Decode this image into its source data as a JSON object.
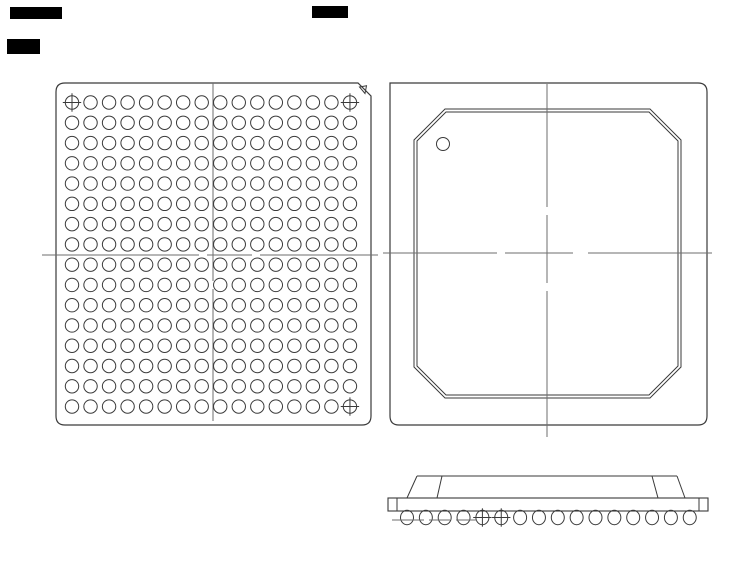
{
  "document": {
    "kind": "bga-package-mechanical-drawing",
    "background": "#ffffff",
    "line_color": "#3a3a3a",
    "centerline_color": "#6e6e6e",
    "width": 754,
    "height": 576
  },
  "redactions": [
    {
      "x": 10,
      "y": 7,
      "w": 52,
      "h": 12
    },
    {
      "x": 7,
      "y": 39,
      "w": 33,
      "h": 15
    },
    {
      "x": 312,
      "y": 6,
      "w": 36,
      "h": 12
    }
  ],
  "bottom_view": {
    "name": "package-bottom-view-ball-grid",
    "outline": {
      "x": 56,
      "y": 83,
      "w": 315,
      "h": 342,
      "notch_r": 9,
      "pin1_chamfer": 13
    },
    "pin1_triangle": {
      "points": "359.5,87 366.5,85.8 365,93.5"
    },
    "ball_grid": {
      "cols": 16,
      "rows": 16,
      "x0": 72,
      "y0": 102.5,
      "dx": 18.53,
      "dy": 20.27,
      "ball_r": 6.7,
      "crosshair_cells": [
        {
          "col": 0,
          "row": 0
        },
        {
          "col": 15,
          "row": 0
        },
        {
          "col": 15,
          "row": 15
        }
      ]
    },
    "centerline_h": {
      "y": 255,
      "segments": [
        [
          42,
          199
        ],
        [
          207,
          252
        ],
        [
          260,
          378
        ]
      ]
    },
    "centerline_v": {
      "x": 213,
      "segments": [
        [
          83,
          281
        ],
        [
          289,
          421
        ]
      ]
    }
  },
  "top_view": {
    "name": "package-top-view",
    "outline": {
      "x": 390,
      "y": 83,
      "w": 317,
      "h": 342,
      "notch_r": 9
    },
    "mold_cap_outer": {
      "x": 414,
      "y": 109,
      "w": 267,
      "h": 289,
      "chamfer": 31
    },
    "mold_cap_inner": {
      "x": 417,
      "y": 112,
      "w": 261,
      "h": 283,
      "chamfer": 29
    },
    "pin1_dot": {
      "cx": 443,
      "cy": 144,
      "r": 6.5
    },
    "centerline_h": {
      "y": 253,
      "segments": [
        [
          383,
          497
        ],
        [
          505,
          573
        ],
        [
          588,
          712
        ]
      ]
    },
    "centerline_v": {
      "x": 547,
      "segments": [
        [
          84,
          207
        ],
        [
          215,
          283
        ],
        [
          291,
          437
        ]
      ]
    }
  },
  "side_view": {
    "name": "package-side-view",
    "substrate_bar": {
      "x": 388,
      "y": 498,
      "w": 320,
      "h": 13
    },
    "end_dividers_x": [
      397,
      699
    ],
    "mold_cap_top": {
      "x1": 417,
      "x2": 677,
      "y": 476
    },
    "mold_cap_slants": [
      [
        417,
        476,
        407,
        498
      ],
      [
        442,
        476,
        437,
        498
      ],
      [
        652,
        476,
        658,
        498
      ],
      [
        677,
        476,
        685,
        498
      ]
    ],
    "balls": {
      "count": 16,
      "x0": 407,
      "dx": 18.85,
      "y": 517.5,
      "rx": 6.5,
      "ry": 7.2,
      "crosshair_indices": [
        4,
        5
      ]
    },
    "seating_dashes": {
      "y": 520,
      "segments": [
        [
          392,
          424
        ],
        [
          429,
          450
        ],
        [
          456,
          477
        ]
      ]
    }
  },
  "icons": {
    "crosshair_ball": "fiducial-crosshair-ball-icon",
    "pin1_triangle": "pin1-triangle-marker-icon",
    "pin1_dot": "pin1-dot-marker-icon"
  }
}
